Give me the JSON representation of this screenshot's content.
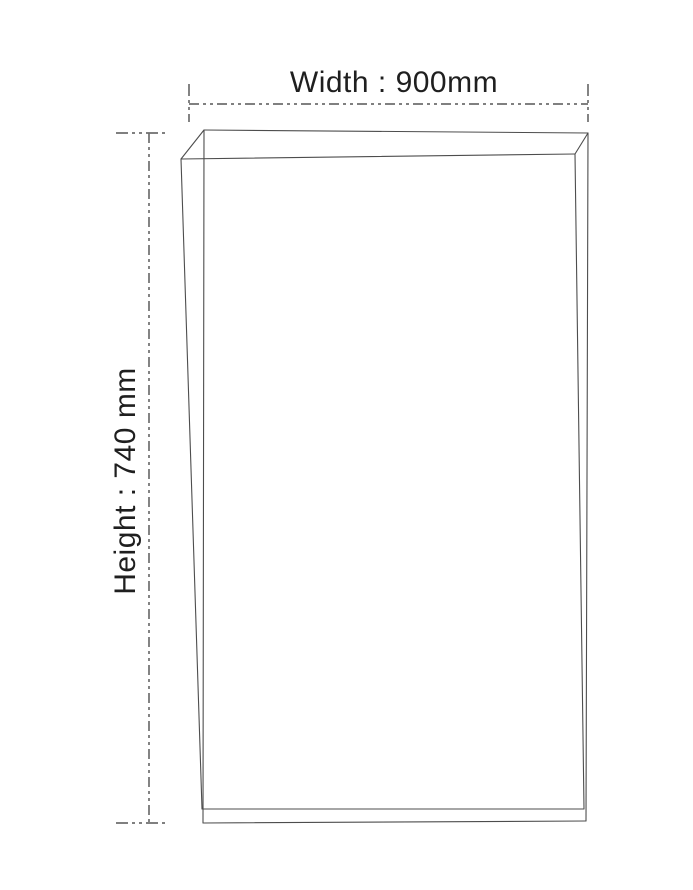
{
  "diagram": {
    "type": "dimension-diagram",
    "width_label": "Width : 900mm",
    "height_label": "Height : 740 mm",
    "width_value_mm": 900,
    "height_value_mm": 740,
    "colors": {
      "background": "#ffffff",
      "panel_line": "#4d4d4d",
      "dimension_line": "#6e6e6e",
      "label_text": "#1f1f1f"
    }
  }
}
